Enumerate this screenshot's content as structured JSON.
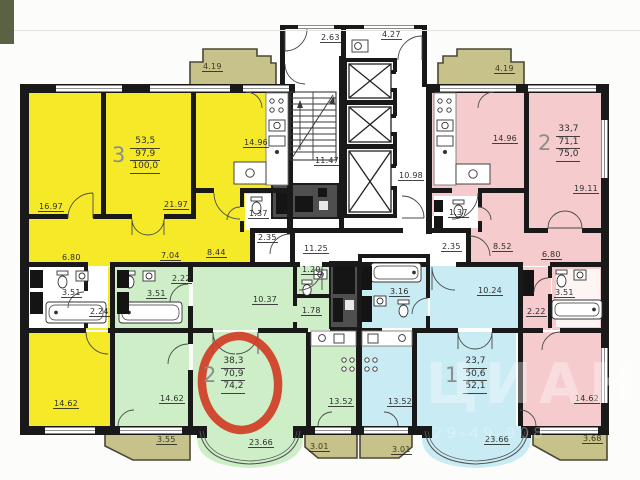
{
  "apartments": {
    "yellow_3room": {
      "number": "3",
      "living_area": "53,5",
      "total_area": "97,9",
      "area_with_balcony": "100,0"
    },
    "pink_2room": {
      "number": "2",
      "living_area": "33,7",
      "total_area": "71,1",
      "area_with_balcony": "75,0"
    },
    "green_2room": {
      "number": "2",
      "living_area": "38,3",
      "total_area": "70,9",
      "area_with_balcony": "74,2"
    },
    "cyan_1room": {
      "number": "1",
      "living_area": "23,7",
      "total_area": "50,6",
      "area_with_balcony": "52,1"
    }
  },
  "dimensions": {
    "balcony_top_left": "4.19",
    "vestibule": "2.63",
    "refuse_room": "4.27",
    "balcony_top_right": "4.19",
    "stairwell": "11.47",
    "lift_lobby": "10.98",
    "corridor": "11.25",
    "tambour_left": "2.35",
    "tambour_right": "2.35",
    "y_room1": "16.97",
    "y_room2": "21.97",
    "y_kitchen": "14.96",
    "y_wc": "1.37",
    "y_hall1": "6.80",
    "y_hall2": "7.04",
    "y_hall3": "8.44",
    "y_bath": "3.51",
    "y_corr": "2.24",
    "y_room3": "14.62",
    "p_kitchen": "14.96",
    "p_wc": "1.37",
    "p_hall1": "8.52",
    "p_hall2": "6.80",
    "p_bath": "3.51",
    "p_corr": "2.22",
    "p_room1": "19.11",
    "p_room2": "14.62",
    "g_hall": "10.37",
    "g_wc": "1.20",
    "g_corr": "1.78",
    "g_bath": "3.51",
    "g_corr2": "2.22",
    "g_room1": "23.66",
    "g_room2": "14.62",
    "g_kitchen": "13.52",
    "c_hall": "10.24",
    "c_bath": "3.16",
    "c_kitchen": "13.52",
    "c_room": "23.66",
    "balcony_b1": "3.55",
    "balcony_b2": "3.01",
    "balcony_b3": "3.01",
    "balcony_b4": "3.68"
  },
  "watermark": {
    "logo": "ЦИАН",
    "code": "29-49-908"
  },
  "colors": {
    "apartment_yellow": "#f6ea28",
    "apartment_pink": "#f5cbcd",
    "apartment_green": "#cdeec6",
    "apartment_cyan": "#c9ebf3",
    "balcony_olive": "#c7c289",
    "highlight_red": "#d13c25",
    "wall_black": "#191919"
  }
}
